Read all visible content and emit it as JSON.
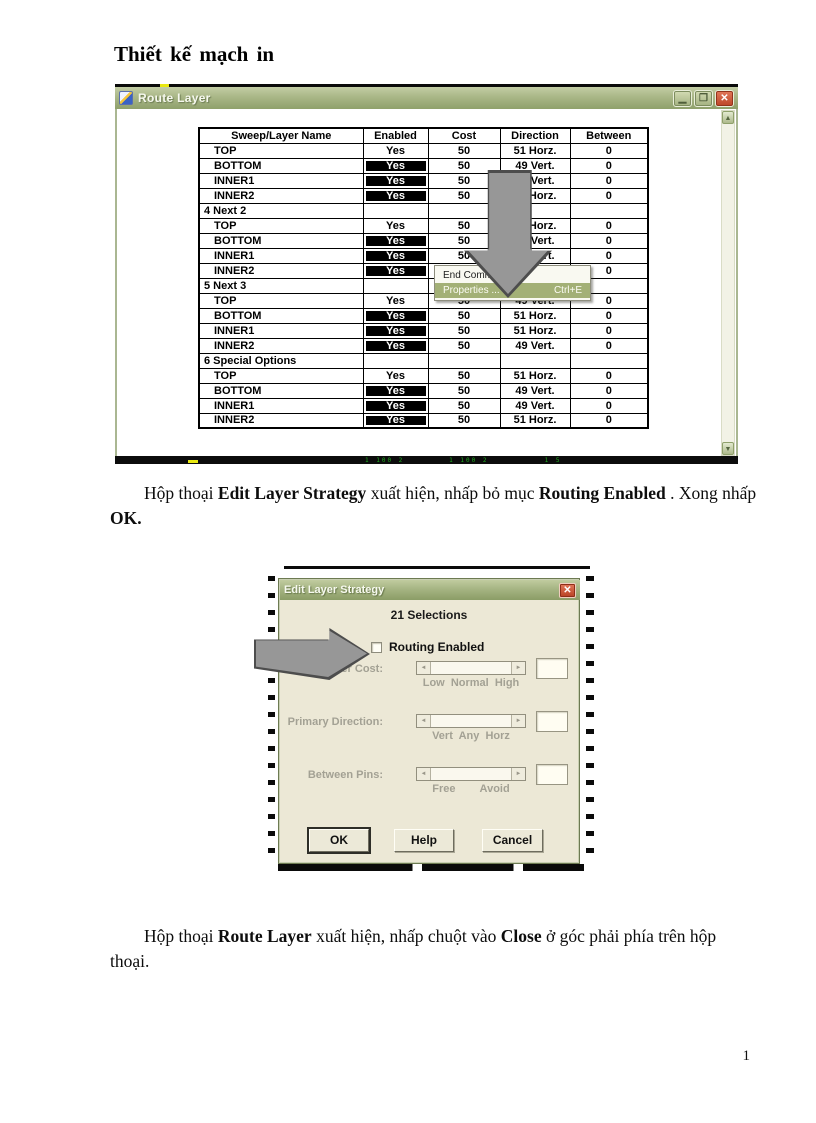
{
  "page": {
    "title": "Thiết kế mạch in",
    "page_number": "1"
  },
  "icons": {
    "minimize": "▁",
    "maximize": "❐",
    "close": "✕",
    "scroll_up": "▲",
    "scroll_down": "▼",
    "scroll_left": "◄",
    "scroll_right": "►"
  },
  "colors": {
    "titlebar_olive": "#a9b787",
    "close_red": "#bb4427",
    "menu_highlight": "#a3b076",
    "selected_cell_bg": "#000000",
    "selected_cell_text": "#ffffff",
    "dialog_bg": "#ece8d6",
    "disabled_text": "#a3a194",
    "arrow_gray": "#979797"
  },
  "window": {
    "title": "Route Layer",
    "status_marks": "1 100 2        1 100 2          1 5",
    "table": {
      "headers": [
        "Sweep/Layer Name",
        "Enabled",
        "Cost",
        "Direction",
        "Between"
      ],
      "rows": [
        {
          "type": "data",
          "name": "TOP",
          "enabled": "Yes",
          "selected": false,
          "cost": "50",
          "direction": "51 Horz.",
          "between": "0"
        },
        {
          "type": "data",
          "name": "BOTTOM",
          "enabled": "Yes",
          "selected": true,
          "cost": "50",
          "direction": "49 Vert.",
          "between": "0"
        },
        {
          "type": "data",
          "name": "INNER1",
          "enabled": "Yes",
          "selected": true,
          "cost": "50",
          "direction": "49 Vert.",
          "between": "0"
        },
        {
          "type": "data",
          "name": "INNER2",
          "enabled": "Yes",
          "selected": true,
          "cost": "50",
          "direction": "51 Horz.",
          "between": "0"
        },
        {
          "type": "section",
          "name": "4 Next 2"
        },
        {
          "type": "data",
          "name": "TOP",
          "enabled": "Yes",
          "selected": false,
          "cost": "50",
          "direction": "51 Horz.",
          "between": "0"
        },
        {
          "type": "data",
          "name": "BOTTOM",
          "enabled": "Yes",
          "selected": true,
          "cost": "50",
          "direction": "49 Vert.",
          "between": "0"
        },
        {
          "type": "data",
          "name": "INNER1",
          "enabled": "Yes",
          "selected": true,
          "cost": "50",
          "direction": "49 Vert.",
          "between": "0"
        },
        {
          "type": "data",
          "name": "INNER2",
          "enabled": "Yes",
          "selected": true,
          "cost": "50",
          "direction": "49 Vert.",
          "between": "0"
        },
        {
          "type": "section",
          "name": "5 Next 3"
        },
        {
          "type": "data",
          "name": "TOP",
          "enabled": "Yes",
          "selected": false,
          "cost": "50",
          "direction": "49 Vert.",
          "between": "0"
        },
        {
          "type": "data",
          "name": "BOTTOM",
          "enabled": "Yes",
          "selected": true,
          "cost": "50",
          "direction": "51 Horz.",
          "between": "0"
        },
        {
          "type": "data",
          "name": "INNER1",
          "enabled": "Yes",
          "selected": true,
          "cost": "50",
          "direction": "51 Horz.",
          "between": "0"
        },
        {
          "type": "data",
          "name": "INNER2",
          "enabled": "Yes",
          "selected": true,
          "cost": "50",
          "direction": "49 Vert.",
          "between": "0"
        },
        {
          "type": "section",
          "name": "6 Special Options"
        },
        {
          "type": "data",
          "name": "TOP",
          "enabled": "Yes",
          "selected": false,
          "cost": "50",
          "direction": "51 Horz.",
          "between": "0"
        },
        {
          "type": "data",
          "name": "BOTTOM",
          "enabled": "Yes",
          "selected": true,
          "cost": "50",
          "direction": "49 Vert.",
          "between": "0"
        },
        {
          "type": "data",
          "name": "INNER1",
          "enabled": "Yes",
          "selected": true,
          "cost": "50",
          "direction": "49 Vert.",
          "between": "0"
        },
        {
          "type": "data",
          "name": "INNER2",
          "enabled": "Yes",
          "selected": true,
          "cost": "50",
          "direction": "51 Horz.",
          "between": "0"
        }
      ]
    },
    "context_menu": {
      "items": [
        {
          "label": "End Command",
          "shortcut": "",
          "highlighted": false
        },
        {
          "label": "Properties ...",
          "shortcut": "Ctrl+E",
          "highlighted": true
        }
      ]
    }
  },
  "paragraph1": {
    "runs": [
      {
        "text": "Hộp thoại ",
        "bold": false
      },
      {
        "text": "Edit Layer Strategy",
        "bold": true
      },
      {
        "text": " xuất hiện, nhấp bỏ mục ",
        "bold": false
      },
      {
        "text": "Routing Enabled",
        "bold": true
      },
      {
        "text": " . Xong nhấp ",
        "bold": false
      },
      {
        "text": "OK.",
        "bold": true
      }
    ]
  },
  "dialog": {
    "title": "Edit Layer Strategy",
    "selections_text": "21 Selections",
    "checkbox_label": "Routing Enabled",
    "checkbox_checked": false,
    "groups": [
      {
        "label": "Layer Cost:",
        "scale": "Low  Normal  High"
      },
      {
        "label": "Primary Direction:",
        "scale": "Vert  Any  Horz"
      },
      {
        "label": "Between Pins:",
        "scale": "Free        Avoid"
      }
    ],
    "buttons": [
      "OK",
      "Help",
      "Cancel"
    ]
  },
  "paragraph2": {
    "runs": [
      {
        "text": "Hộp thoại ",
        "bold": false
      },
      {
        "text": "Route Layer",
        "bold": true
      },
      {
        "text": " xuất hiện,  nhấp chuột vào ",
        "bold": false
      },
      {
        "text": "Close",
        "bold": true
      },
      {
        "text": " ở góc phải phía trên hộp thoại.",
        "bold": false
      }
    ]
  }
}
